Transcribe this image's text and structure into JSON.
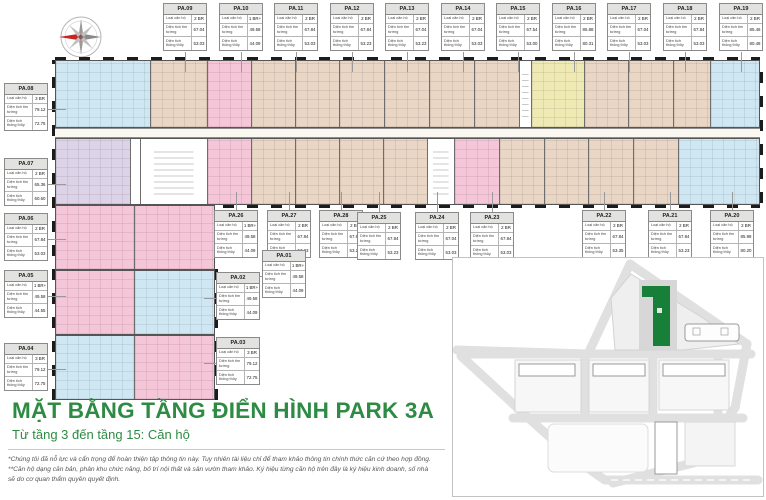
{
  "title": "MẶT BẰNG TẦNG ĐIỂN HÌNH PARK 3A",
  "subtitle": "Từ tầng 3 đến tầng 15: Căn hộ",
  "disclaimer": [
    "*Chúng tôi đã nỗ lực và cẩn trọng để hoàn thiện tập thông tin này. Tuy nhiên tài liệu chỉ để tham khảo thông tin chính thức căn cứ theo hợp đồng.",
    "**Căn hộ dạng căn bản, phân khu chức năng, bố trí nội thất và sân vườn tham khảo. Ký hiệu từng căn hộ trên đây là ký hiệu kinh doanh, số nhà",
    "sẽ do cơ quan thẩm quyền quyết định."
  ],
  "card_labels": {
    "type": "Loại căn hộ",
    "gross": "Diện tích tim tường",
    "net": "Diện tích thông thủy"
  },
  "colors": {
    "accent_green": "#2e8b44",
    "map_building_green": "#177f38",
    "unit_tan": "#e9d6c5",
    "unit_pink": "#f5c6d8",
    "unit_blue": "#cfe7f2",
    "unit_yellow": "#efe9b4",
    "unit_lavender": "#ddd3e8"
  },
  "icons": [
    "compass-rose-icon"
  ],
  "top_cards": [
    {
      "id": "PA.09",
      "type": "2 BR",
      "gross": "67.04",
      "net": "53.03"
    },
    {
      "id": "PA.10",
      "type": "1 BR+",
      "gross": "49.58",
      "net": "44.09"
    },
    {
      "id": "PA.11",
      "type": "2 BR",
      "gross": "67.84",
      "net": "53.03"
    },
    {
      "id": "PA.12",
      "type": "2 BR",
      "gross": "67.84",
      "net": "53.23"
    },
    {
      "id": "PA.13",
      "type": "2 BR",
      "gross": "67.04",
      "net": "53.23"
    },
    {
      "id": "PA.14",
      "type": "2 BR",
      "gross": "67.04",
      "net": "53.03"
    },
    {
      "id": "PA.15",
      "type": "2 BR",
      "gross": "67.54",
      "net": "53.00"
    },
    {
      "id": "PA.16",
      "type": "2 BR",
      "gross": "85.88",
      "net": "80.31"
    },
    {
      "id": "PA.17",
      "type": "2 BR",
      "gross": "67.04",
      "net": "53.03"
    },
    {
      "id": "PA.18",
      "type": "2 BR",
      "gross": "67.84",
      "net": "53.03"
    },
    {
      "id": "PA.19",
      "type": "2 BR",
      "gross": "85.46",
      "net": "80.48"
    }
  ],
  "mid_cards": [
    {
      "id": "PA.26",
      "type": "1 BR+",
      "gross": "49.58",
      "net": "44.09"
    },
    {
      "id": "PA.27",
      "type": "2 BR",
      "gross": "67.84",
      "net": "53.23"
    },
    {
      "id": "PA.28",
      "type": "2 BR",
      "gross": "67.84",
      "net": "53.23"
    },
    {
      "id": "PA.25",
      "type": "2 BR",
      "gross": "67.84",
      "net": "53.23"
    },
    {
      "id": "PA.24",
      "type": "2 BR",
      "gross": "67.04",
      "net": "53.03"
    },
    {
      "id": "PA.23",
      "type": "2 BR",
      "gross": "67.84",
      "net": "53.03"
    },
    {
      "id": "PA.22",
      "type": "2 BR",
      "gross": "67.84",
      "net": "53.35"
    },
    {
      "id": "PA.21",
      "type": "2 BR",
      "gross": "67.84",
      "net": "53.23"
    },
    {
      "id": "PA.20",
      "type": "2 BR",
      "gross": "85.98",
      "net": "80.20"
    }
  ],
  "left_cards": [
    {
      "id": "PA.08",
      "type": "3 BR",
      "gross": "79.12",
      "net": "72.75"
    },
    {
      "id": "PA.07",
      "type": "2 BR",
      "gross": "65.36",
      "net": "60.60"
    },
    {
      "id": "PA.06",
      "type": "2 BR",
      "gross": "67.84",
      "net": "53.03"
    },
    {
      "id": "PA.05",
      "type": "1 BR+",
      "gross": "49.58",
      "net": "44.55"
    },
    {
      "id": "PA.04",
      "type": "3 BR",
      "gross": "79.12",
      "net": "72.75"
    }
  ],
  "low_cards": [
    {
      "id": "PA.01",
      "type": "1 BR+",
      "gross": "49.58",
      "net": "44.09"
    },
    {
      "id": "PA.02",
      "type": "1 BR+",
      "gross": "49.58",
      "net": "44.09"
    },
    {
      "id": "PA.03",
      "type": "3 BR",
      "gross": "79.12",
      "net": "72.75"
    }
  ]
}
